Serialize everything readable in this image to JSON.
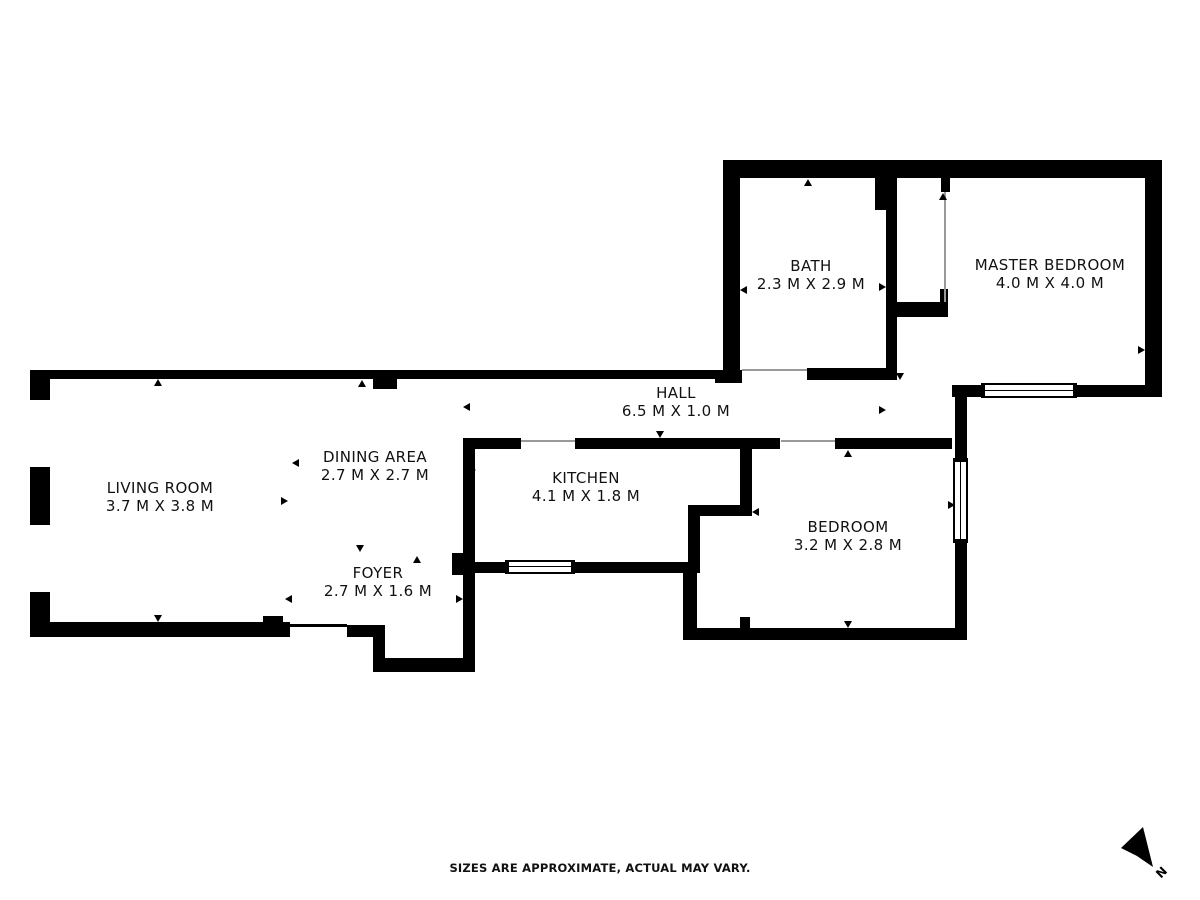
{
  "rooms": [
    {
      "id": "living-room",
      "name": "LIVING ROOM",
      "size": "3.7 M X 3.8 M"
    },
    {
      "id": "dining-area",
      "name": "DINING AREA",
      "size": "2.7 M X 2.7 M"
    },
    {
      "id": "foyer",
      "name": "FOYER",
      "size": "2.7 M X 1.6 M"
    },
    {
      "id": "kitchen",
      "name": "KITCHEN",
      "size": "4.1 M X 1.8 M"
    },
    {
      "id": "hall",
      "name": "HALL",
      "size": "6.5 M X 1.0 M"
    },
    {
      "id": "bath",
      "name": "BATH",
      "size": "2.3 M X 2.9 M"
    },
    {
      "id": "master-bedroom",
      "name": "MASTER BEDROOM",
      "size": "4.0 M X 4.0 M"
    },
    {
      "id": "bedroom",
      "name": "BEDROOM",
      "size": "3.2 M X 2.8 M"
    }
  ],
  "footer": {
    "disclaimer": "SIZES ARE APPROXIMATE, ACTUAL MAY VARY."
  },
  "compass": {
    "label": "N"
  },
  "colors": {
    "wall": "#000000",
    "background": "#ffffff",
    "door_line": "#999999"
  }
}
